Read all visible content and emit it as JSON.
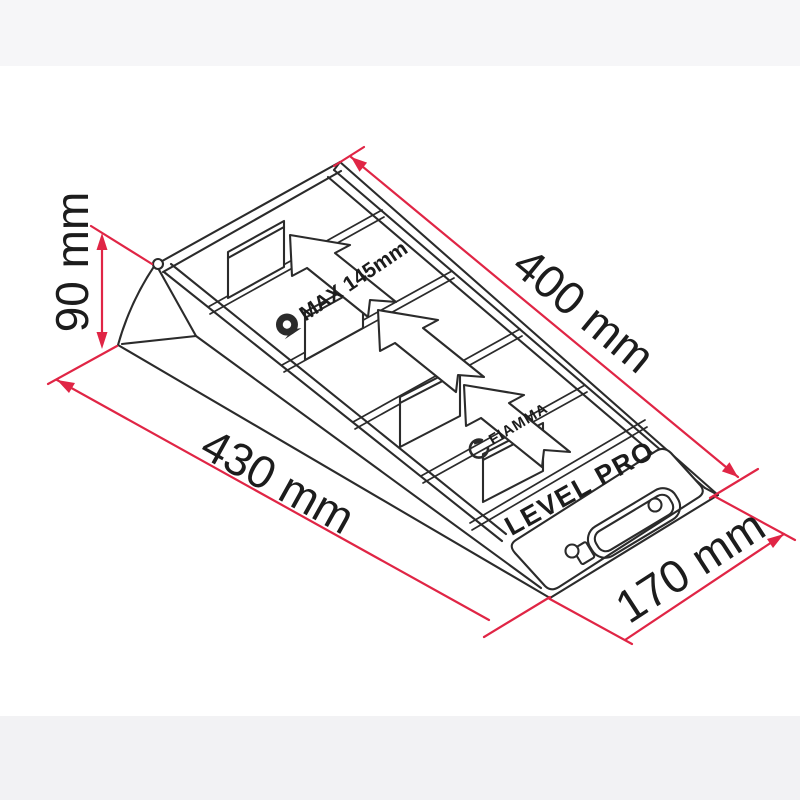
{
  "dimensions": {
    "height": {
      "label": "90 mm"
    },
    "slope_length": {
      "label": "400 mm"
    },
    "overall_length": {
      "label": "430 mm"
    },
    "width": {
      "label": "170 mm"
    }
  },
  "markings": {
    "max_height": "MAX 145mm",
    "brand": "FIAMMA",
    "model": "LEVEL PRO"
  },
  "icons": {
    "wheel": "wheel-icon",
    "brand_swoosh": "fiamma-swoosh-icon"
  },
  "colors": {
    "dimension_line": "#e02545",
    "drawing_line": "#2b2b2b",
    "label_text": "#1c1c1c",
    "background": "#ffffff",
    "band_top": "#f6f6f8",
    "band_bottom": "#f2f2f4"
  }
}
